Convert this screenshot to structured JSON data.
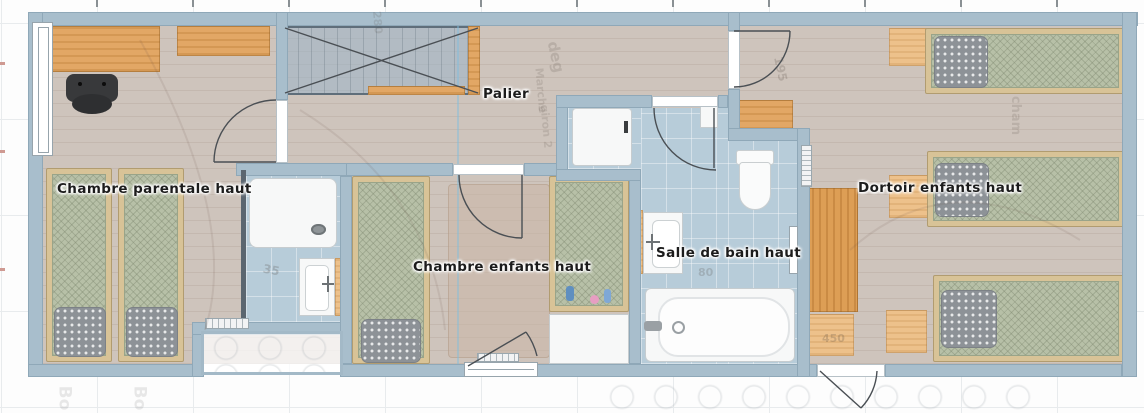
{
  "plan": {
    "rooms": {
      "parentale": {
        "label": "Chambre parentale haut"
      },
      "palier": {
        "label": "Palier"
      },
      "enfants": {
        "label": "Chambre enfants haut"
      },
      "bain": {
        "label": "Salle de bain haut"
      },
      "dortoir": {
        "label": "Dortoir enfants haut"
      }
    },
    "annotations": {
      "deg": "deg",
      "marche": "Marche",
      "giron": "giron 2",
      "n280": "280",
      "n195": "195",
      "n35": "35",
      "n80": "80",
      "n450": "450",
      "cham": "cham",
      "bo1": "Bo",
      "bo2": "Bo"
    },
    "colors": {
      "wall": "#a8becc",
      "floor_wood": "#cec4bc",
      "tile": "#b7ccd9",
      "mattress": "#b7c0a7",
      "pillow": "#8d9297",
      "wood": "#e2a765",
      "stair": "#9bb4c8",
      "accent_line": "#7dbee1"
    }
  }
}
